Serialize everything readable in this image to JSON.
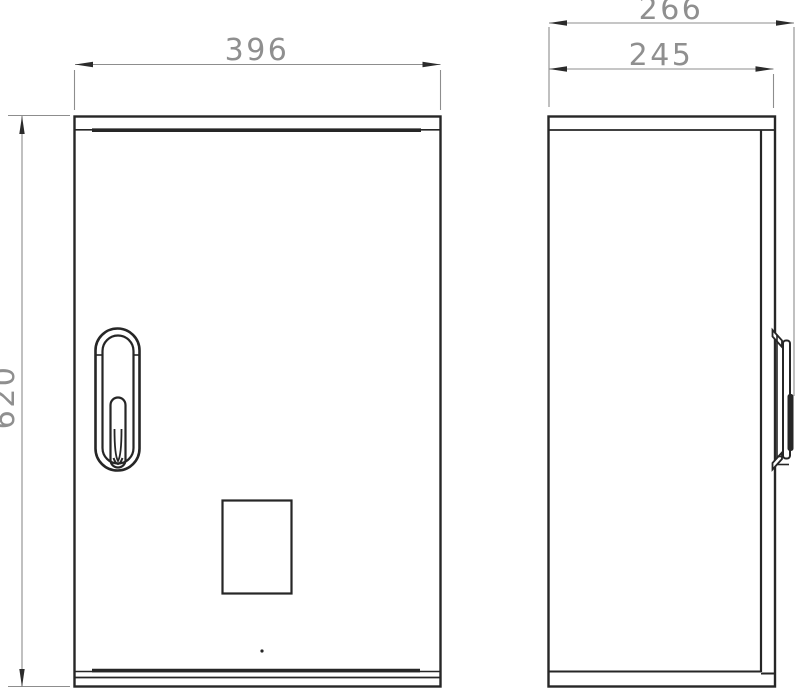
{
  "drawing": {
    "type": "technical-drawing",
    "views": [
      "front",
      "side"
    ],
    "dimensions": {
      "front_width": "396",
      "front_height": "620",
      "side_overall_depth": "266",
      "side_body_depth": "245"
    },
    "colors": {
      "background": "#ffffff",
      "outline": "#262626",
      "dimension_line": "#8d8d8d",
      "dimension_text": "#8f8f8f",
      "arrowhead": "#2b2b2b"
    }
  }
}
